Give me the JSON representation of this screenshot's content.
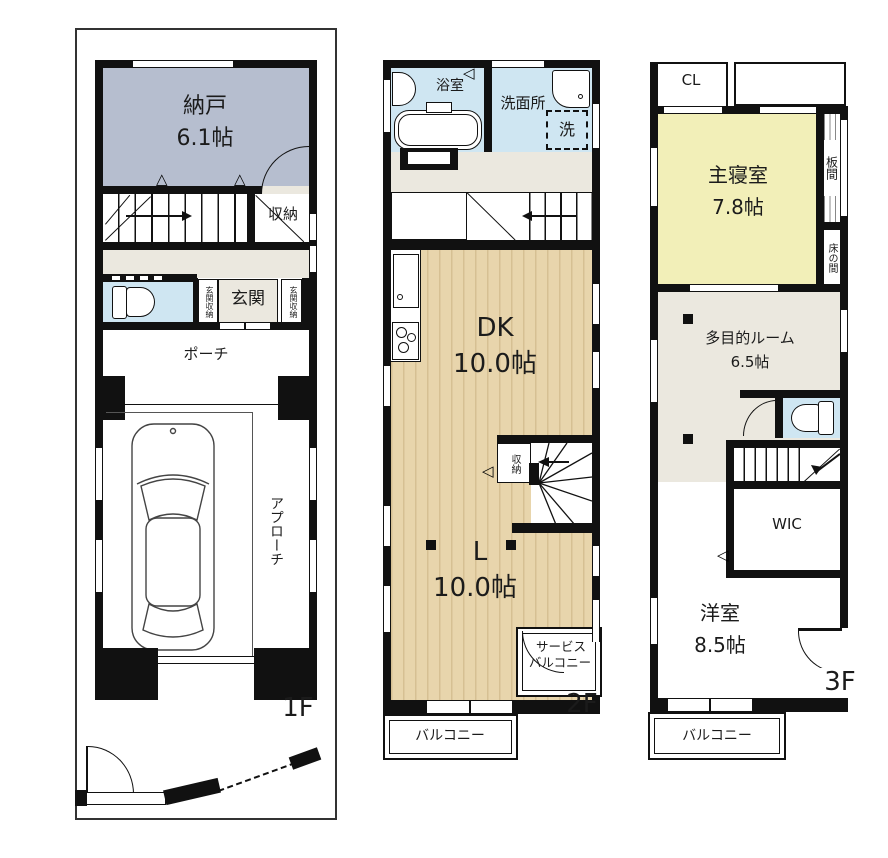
{
  "title": "3-story house floor plan",
  "colors": {
    "wall": "#111111",
    "boundary": "#333333",
    "storage_gray": "#b6becf",
    "water_blue": "#cfe6f2",
    "room_yellow": "#f2efb8",
    "hall_beige": "#ebe8df",
    "wood_floor": "#e8d5ac",
    "wood_stripe": "#d6c093"
  },
  "symbols": {
    "tri_up": "△",
    "tri_left": "◁"
  },
  "f1": {
    "floor_label": "1F",
    "nando": {
      "name": "納戸",
      "size": "6.1帖"
    },
    "shuno": "収納",
    "genkan_storage_left": "玄関収納",
    "genkan": "玄関",
    "genkan_storage_right": "玄関収納",
    "porch": "ポーチ",
    "approach": "アプローチ"
  },
  "f2": {
    "floor_label": "2F",
    "bath": "浴室",
    "washroom": "洗面所",
    "washer": "洗",
    "dk": {
      "name": "DK",
      "size": "10.0帖"
    },
    "shuno": "収納",
    "living": {
      "name": "L",
      "size": "10.0帖"
    },
    "service_balcony": {
      "line1": "サービス",
      "line2": "バルコニー"
    },
    "balcony": "バルコニー"
  },
  "f3": {
    "floor_label": "3F",
    "cl": "CL",
    "master": {
      "name": "主寝室",
      "size": "7.8帖"
    },
    "itanoma": "板間",
    "tokonoma": "床の間",
    "multi": {
      "name": "多目的ルーム",
      "size": "6.5帖"
    },
    "wic": "WIC",
    "western": {
      "name": "洋室",
      "size": "8.5帖"
    },
    "balcony": "バルコニー"
  }
}
